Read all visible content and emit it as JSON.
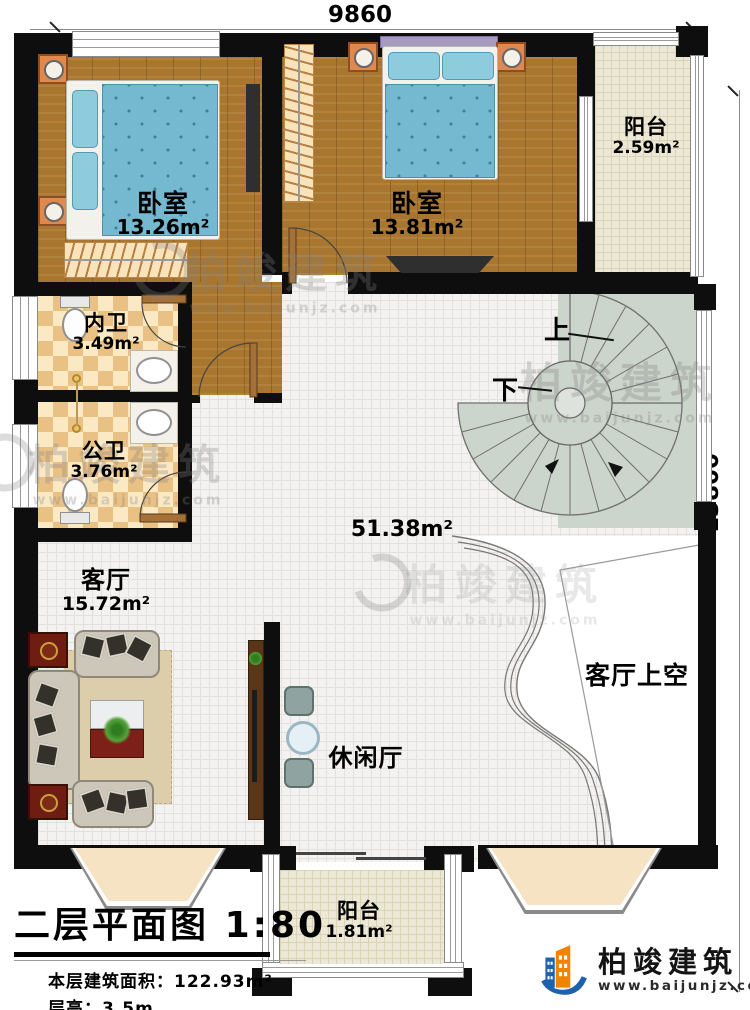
{
  "dimensions": {
    "width": "9860",
    "height": "13800"
  },
  "rooms": [
    {
      "id": "bedroom-1",
      "name": "卧室",
      "area": "13.26m²"
    },
    {
      "id": "bedroom-2",
      "name": "卧室",
      "area": "13.81m²"
    },
    {
      "id": "balcony-top",
      "name": "阳台",
      "area": "2.59m²"
    },
    {
      "id": "bath-private",
      "name": "内卫",
      "area": "3.49m²"
    },
    {
      "id": "bath-public",
      "name": "公卫",
      "area": "3.76m²"
    },
    {
      "id": "hall",
      "name": "",
      "area": "51.38m²"
    },
    {
      "id": "living-room",
      "name": "客厅",
      "area": "15.72m²"
    },
    {
      "id": "leisure-hall",
      "name": "休闲厅",
      "area": ""
    },
    {
      "id": "living-void",
      "name": "客厅上空",
      "area": ""
    },
    {
      "id": "balcony-bottom",
      "name": "阳台",
      "area": "1.81m²"
    }
  ],
  "stairs": {
    "up_label": "上",
    "down_label": "下"
  },
  "title_block": {
    "title": "二层平面图",
    "scale": "1:80",
    "floor_area_label": "本层建筑面积：",
    "floor_area_value": "122.93m²",
    "floor_height_label": "层高：",
    "floor_height_value": "3.5m"
  },
  "brand": {
    "name": "柏竣建筑",
    "website": "www.baijunjz.com"
  },
  "watermark": {
    "name": "柏竣建筑",
    "website": "www.baijunjz.com"
  },
  "colors": {
    "wall": "#0e0e0e",
    "wood_floor": "#a8762f",
    "tile_floor": "#f3f2f0",
    "checker_tan": "#eac185",
    "balcony_floor": "#ece8d5",
    "stair": "#ccd5cb",
    "bed_blue": "#74b9cf",
    "nightstand_orange": "#e0894f",
    "brand_blue": "#1e62ad",
    "brand_orange": "#f08300"
  }
}
